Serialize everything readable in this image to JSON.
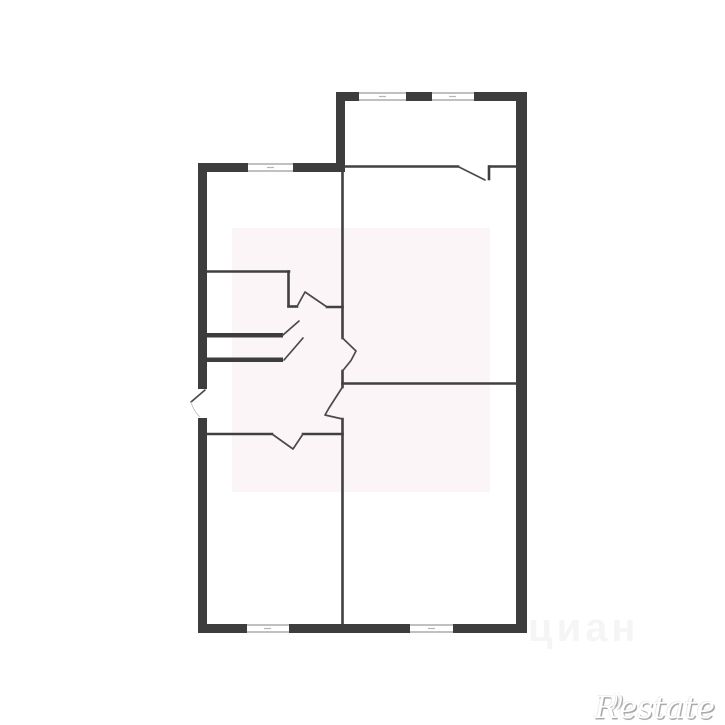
{
  "image_type": "apartment-floor-plan",
  "watermarks": {
    "restate": "Restate",
    "restate_flick": "))",
    "cian": "циан"
  },
  "colors": {
    "background": "#ffffff",
    "outer_wall": "#3d3d3d",
    "interior_wall": "#404040",
    "window_frame": "#9a9a9a",
    "door_line": "#4a4a4a",
    "watermark_tint": "#f7edf1",
    "logo_gray": "#a8a8a8"
  },
  "floor_plan": {
    "windows_count": 5,
    "door_openings_count": 6,
    "closet_shelves_count": 2
  }
}
